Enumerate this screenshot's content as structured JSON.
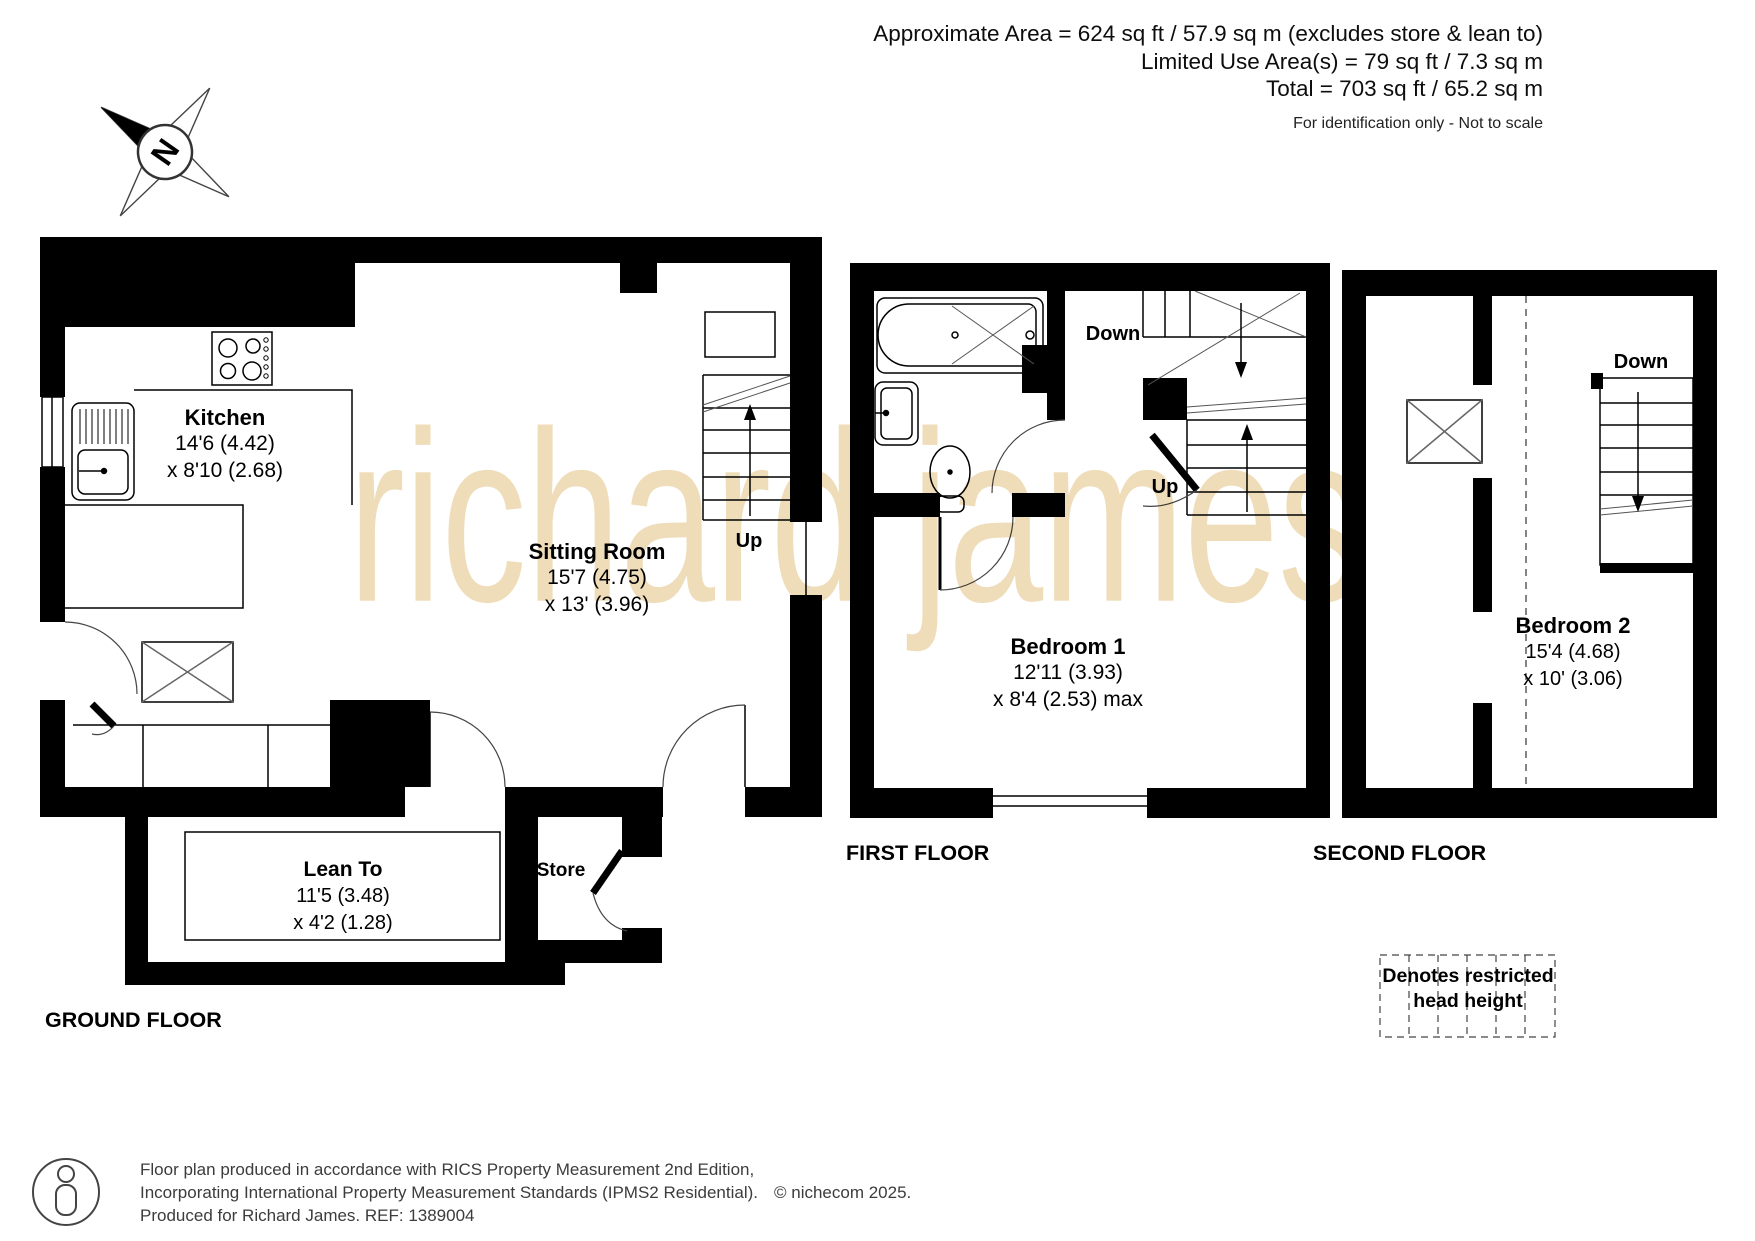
{
  "header": {
    "line1": "Approximate Area = 624 sq ft / 57.9 sq m (excludes store & lean to)",
    "line2": "Limited Use Area(s) = 79 sq ft / 7.3 sq m",
    "line3": "Total = 703 sq ft / 65.2 sq m",
    "note": "For identification only - Not to scale"
  },
  "watermark": "richard james",
  "compass": {
    "letter": "N"
  },
  "ground": {
    "label": "GROUND FLOOR",
    "kitchen": {
      "name": "Kitchen",
      "d1": "14'6 (4.42)",
      "d2": "x 8'10 (2.68)"
    },
    "sitting": {
      "name": "Sitting Room",
      "d1": "15'7 (4.75)",
      "d2": "x 13' (3.96)"
    },
    "leanto": {
      "name": "Lean To",
      "d1": "11'5 (3.48)",
      "d2": "x 4'2 (1.28)"
    },
    "store": "Store",
    "up": "Up"
  },
  "first": {
    "label": "FIRST FLOOR",
    "bedroom1": {
      "name": "Bedroom 1",
      "d1": "12'11 (3.93)",
      "d2": "x 8'4 (2.53) max"
    },
    "down": "Down",
    "up": "Up"
  },
  "second": {
    "label": "SECOND FLOOR",
    "bedroom2": {
      "name": "Bedroom 2",
      "d1": "15'4 (4.68)",
      "d2": "x 10' (3.06)"
    },
    "down": "Down"
  },
  "legend": {
    "line1": "Denotes restricted",
    "line2": "head height"
  },
  "footer": {
    "line1": "Floor plan produced in accordance with RICS Property Measurement 2nd Edition,",
    "line2": "Incorporating International Property Measurement Standards (IPMS2 Residential).",
    "copyright": "© nichecom 2025.",
    "line3": "Produced for Richard James.   REF:  1389004"
  },
  "colors": {
    "wall": "#000000",
    "watermark": "#efddba"
  }
}
